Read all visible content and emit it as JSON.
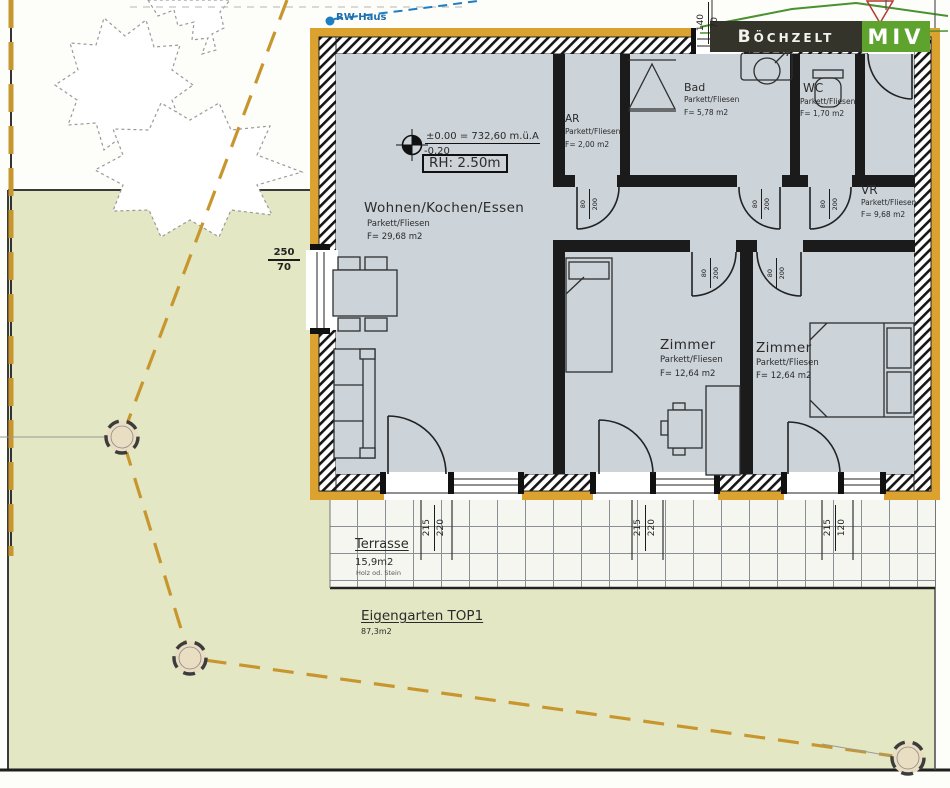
{
  "logo": {
    "name": "Böchzelt",
    "division": "MIV"
  },
  "site": {
    "rw_haus": "RW Haus",
    "eigengarten_title": "Eigengarten TOP1",
    "eigengarten_area": "87,3m2",
    "terrasse_title": "Terrasse",
    "terrasse_area": "15,9m2",
    "terrasse_material": "Holz od. Stein"
  },
  "level": {
    "upper": "±0.00 = 732,60 m.ü.A",
    "lower": "-0,20",
    "room_height": "RH: 2.50m"
  },
  "rooms": {
    "wohnen": {
      "name": "Wohnen/Kochen/Essen",
      "floor": "Parkett/Fliesen",
      "area": "F= 29,68 m2"
    },
    "ar": {
      "name": "AR",
      "floor": "Parkett/Fliesen",
      "area": "F= 2,00 m2"
    },
    "bad": {
      "name": "Bad",
      "floor": "Parkett/Fliesen",
      "area": "F= 5,78 m2"
    },
    "wc": {
      "name": "WC",
      "floor": "Parkett/Fliesen",
      "area": "F= 1,70 m2"
    },
    "vr": {
      "name": "VR",
      "floor": "Parkett/Fliesen",
      "area": "F= 9,68 m2"
    },
    "zimmer1": {
      "name": "Zimmer",
      "floor": "Parkett/Fliesen",
      "area": "F= 12,64 m2"
    },
    "zimmer2": {
      "name": "Zimmer",
      "floor": "Parkett/Fliesen",
      "area": "F= 12,64 m2"
    }
  },
  "dimensions": {
    "top_window": {
      "a": "140",
      "b": "70"
    },
    "left_window": {
      "a": "250",
      "b": "70"
    },
    "door": {
      "a": "80",
      "b": "200"
    },
    "bottom_1": {
      "a": "215",
      "b": "220"
    },
    "bottom_2": {
      "a": "215",
      "b": "220"
    },
    "bottom_3": {
      "a": "215",
      "b": "120"
    }
  },
  "colors": {
    "wall_insulation_yellow": "#dba22f",
    "garden_green": "#e3e7c3",
    "floor_grey": "#ccd3d9",
    "logo_green": "#5ea32e",
    "logo_dark": "#34342a",
    "utility_blue": "#1f6fae",
    "boundary_dash_yellow": "#c8962f"
  }
}
